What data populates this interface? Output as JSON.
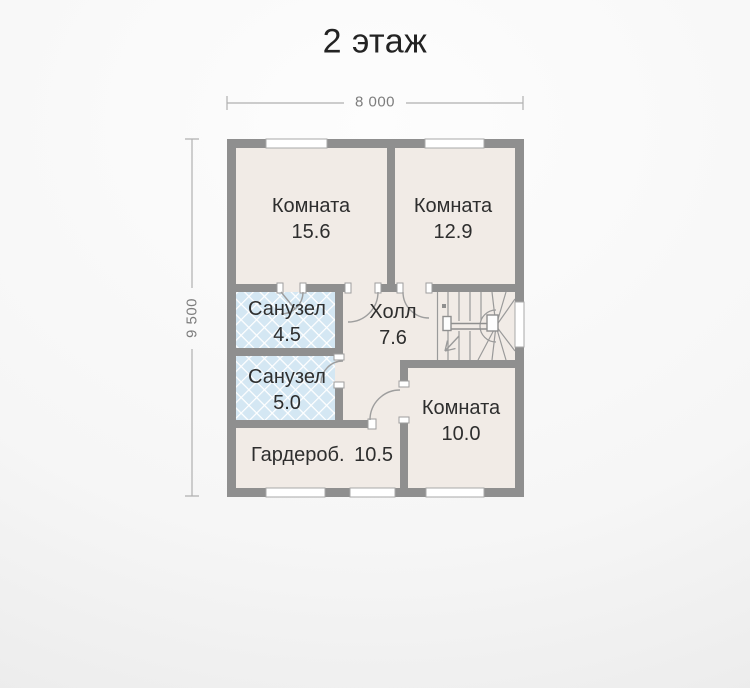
{
  "title": "2 этаж",
  "dimensions": {
    "width": "8 000",
    "height": "9 500"
  },
  "rooms": {
    "bedroom1": {
      "name": "Комната",
      "area": "15.6"
    },
    "bedroom2": {
      "name": "Комната",
      "area": "12.9"
    },
    "bath1": {
      "name": "Санузел",
      "area": "4.5"
    },
    "hall": {
      "name": "Холл",
      "area": "7.6"
    },
    "bath2": {
      "name": "Санузел",
      "area": "5.0"
    },
    "bedroom3": {
      "name": "Комната",
      "area": "10.0"
    },
    "wardrobe": {
      "name": "Гардероб.",
      "area": "10.5"
    }
  },
  "colors": {
    "wall": "#8f8f8f",
    "room_fill": "#f1ebe6",
    "tile_fill": "#d4e7f3",
    "thin_line": "#9e9e9e",
    "dimension_line": "#b0b0b0",
    "dimension_text": "#7d7d7d",
    "title_text": "#232323",
    "label_text": "#2e2e2e"
  }
}
